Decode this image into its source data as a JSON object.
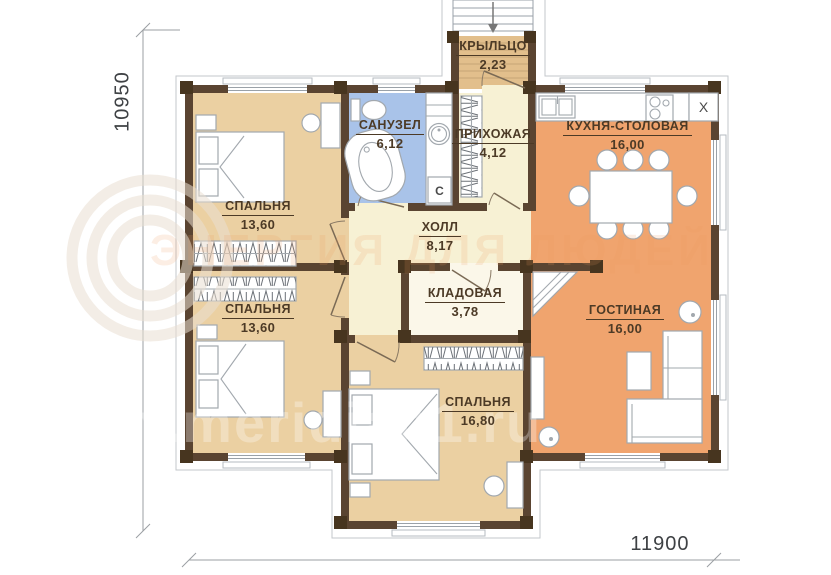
{
  "rooms": {
    "porch": {
      "name": "КРЫЛЬЦО",
      "area": "2,23"
    },
    "bathroom": {
      "name": "САНУЗЕЛ",
      "area": "6,12"
    },
    "entry": {
      "name": "ПРИХОЖАЯ",
      "area": "4,12"
    },
    "kitchen": {
      "name": "КУХНЯ-СТОЛОВАЯ",
      "area": "16,00"
    },
    "bedroom1": {
      "name": "СПАЛЬНЯ",
      "area": "13,60"
    },
    "hall": {
      "name": "ХОЛЛ",
      "area": "8,17"
    },
    "bedroom2": {
      "name": "СПАЛЬНЯ",
      "area": "13,60"
    },
    "storage": {
      "name": "КЛАДОВАЯ",
      "area": "3,78"
    },
    "living": {
      "name": "ГОСТИНАЯ",
      "area": "16,00"
    },
    "bedroom3": {
      "name": "СПАЛЬНЯ",
      "area": "16,80"
    }
  },
  "dimensions": {
    "left": "10950",
    "bottom": "11900"
  },
  "appliances": {
    "washer_label": "С",
    "fridge_label": "X"
  },
  "watermark": {
    "slogan": "ЭНЕРГИЯ ДЛЯ ЛЮДЕЙ",
    "url": "www.meridian1.ru"
  },
  "colors": {
    "wall": "#5a4431",
    "post": "#47351f",
    "bedroom_fill": "#ebd0a2",
    "kitchen_living_fill": "#f0a46e",
    "bathroom_fill": "#a9c3e9",
    "hall_fill": "#f7f1d4",
    "storage_fill": "#fbf7e9",
    "porch_fill": "#e2bf8c",
    "label_text": "#4c3a26"
  }
}
